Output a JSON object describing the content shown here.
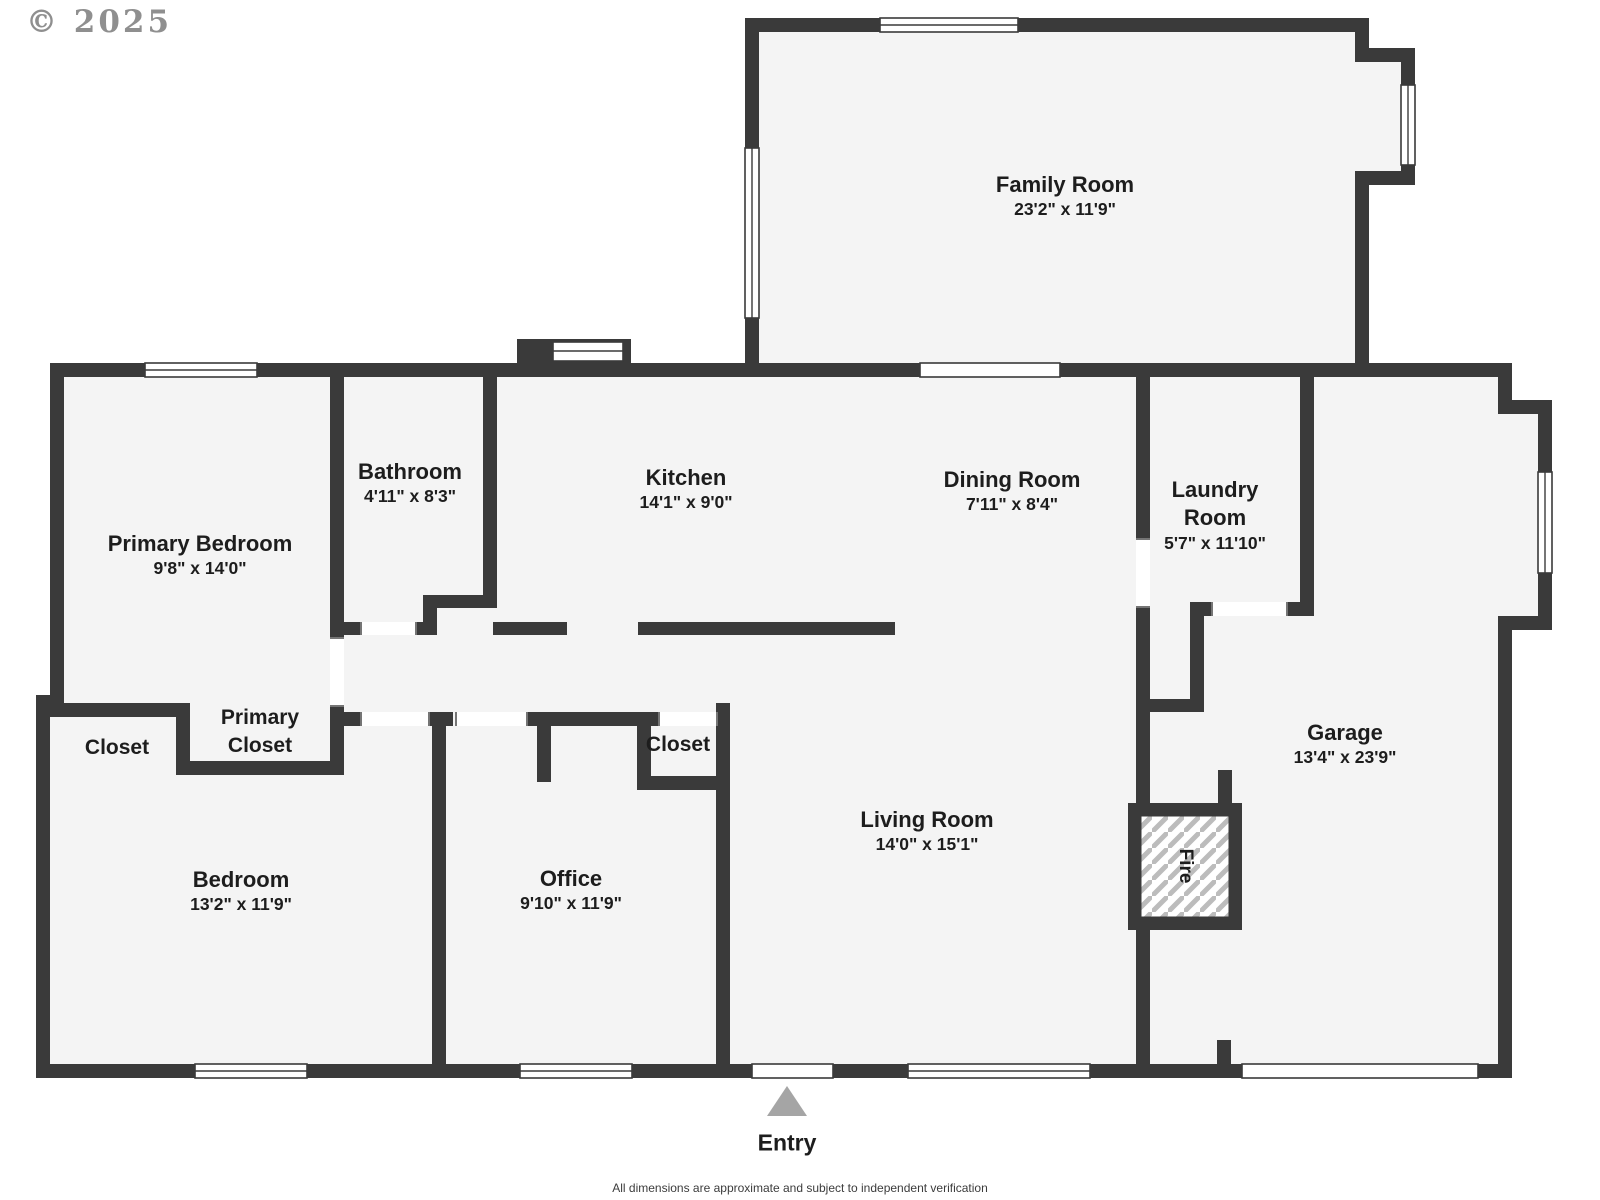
{
  "watermark": "© 2025",
  "footer": {
    "disclaimer": "All dimensions are approximate and subject to independent verification"
  },
  "entry": {
    "label": "Entry"
  },
  "fireplace": {
    "label": "Fire"
  },
  "rooms": {
    "family": {
      "name": "Family Room",
      "dims": "23'2\" x 11'9\""
    },
    "primary_bedroom": {
      "name": "Primary Bedroom",
      "dims": "9'8\" x 14'0\""
    },
    "bathroom": {
      "name": "Bathroom",
      "dims": "4'11\" x 8'3\""
    },
    "kitchen": {
      "name": "Kitchen",
      "dims": "14'1\" x 9'0\""
    },
    "dining": {
      "name": "Dining Room",
      "dims": "7'11\" x 8'4\""
    },
    "laundry": {
      "name": "Laundry Room",
      "dims": "5'7\" x 11'10\""
    },
    "closet_left": {
      "name": "Closet"
    },
    "primary_closet": {
      "name": "Primary Closet"
    },
    "bedroom": {
      "name": "Bedroom",
      "dims": "13'2\" x 11'9\""
    },
    "office": {
      "name": "Office",
      "dims": "9'10\" x 11'9\""
    },
    "closet_small": {
      "name": "Closet"
    },
    "living": {
      "name": "Living Room",
      "dims": "14'0\" x 15'1\""
    },
    "garage": {
      "name": "Garage",
      "dims": "13'4\" x 23'9\""
    }
  },
  "colors": {
    "wall": "#3a3a3a",
    "floor": "#f4f4f4",
    "text": "#1d1d1d",
    "muted": "#8f8f8f",
    "arrow": "#a5a5a5"
  }
}
